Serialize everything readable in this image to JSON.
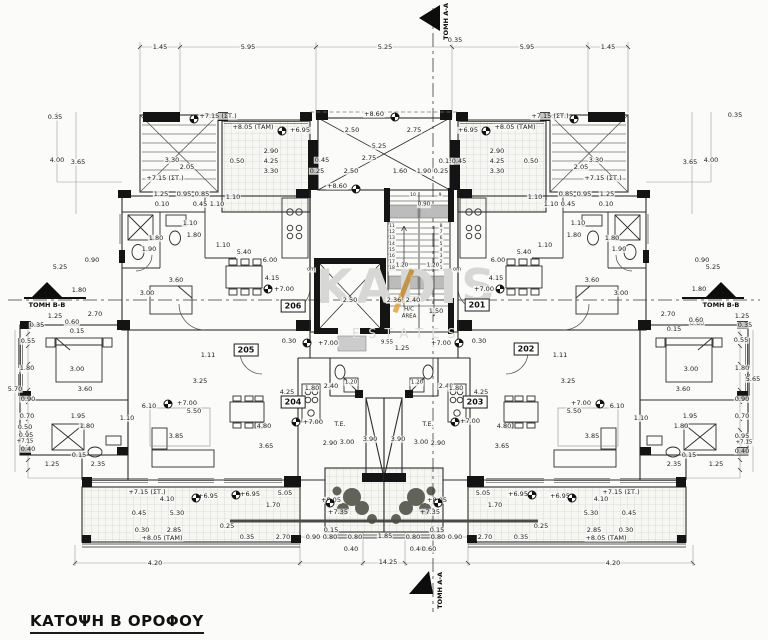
{
  "title": {
    "text": "ΚΑΤΟΨΗ Β ΟΡΟΦΟΥ"
  },
  "watermark": {
    "line1": "KADIS",
    "line2": "ESTATES",
    "accent_color": "#e2a23d"
  },
  "sections": {
    "labels": [
      "ΤΟΜΗ Α-Α",
      "ΤΟΜΗ Α-Α",
      "ΤΟΜΗ Β-Β",
      "ΤΟΜΗ Β-Β"
    ]
  },
  "apartments": [
    {
      "num": "206",
      "x": 293,
      "y": 306
    },
    {
      "num": "201",
      "x": 477,
      "y": 305
    },
    {
      "num": "205",
      "x": 246,
      "y": 350
    },
    {
      "num": "202",
      "x": 526,
      "y": 349
    },
    {
      "num": "204",
      "x": 293,
      "y": 402
    },
    {
      "num": "203",
      "x": 475,
      "y": 402
    }
  ],
  "level_markers": [
    {
      "x": 194,
      "y": 119
    },
    {
      "x": 574,
      "y": 119
    },
    {
      "x": 395,
      "y": 117
    },
    {
      "x": 356,
      "y": 189
    },
    {
      "x": 282,
      "y": 131
    },
    {
      "x": 486,
      "y": 131
    },
    {
      "x": 268,
      "y": 289
    },
    {
      "x": 500,
      "y": 289
    },
    {
      "x": 307,
      "y": 343
    },
    {
      "x": 459,
      "y": 343
    },
    {
      "x": 296,
      "y": 422
    },
    {
      "x": 455,
      "y": 422
    },
    {
      "x": 168,
      "y": 404
    },
    {
      "x": 600,
      "y": 404
    },
    {
      "x": 196,
      "y": 498
    },
    {
      "x": 572,
      "y": 498
    },
    {
      "x": 236,
      "y": 495
    },
    {
      "x": 532,
      "y": 495
    },
    {
      "x": 330,
      "y": 503
    },
    {
      "x": 438,
      "y": 503
    }
  ],
  "annotations": [
    {
      "t": "1.45",
      "x": 160,
      "y": 47
    },
    {
      "t": "5.95",
      "x": 248,
      "y": 47
    },
    {
      "t": "5.25",
      "x": 385,
      "y": 47
    },
    {
      "t": "5.95",
      "x": 527,
      "y": 47
    },
    {
      "t": "1.45",
      "x": 608,
      "y": 47
    },
    {
      "t": "0.35",
      "x": 455,
      "y": 40
    },
    {
      "t": "0.35",
      "x": 55,
      "y": 117
    },
    {
      "t": "0.35",
      "x": 735,
      "y": 115
    },
    {
      "t": "4.00",
      "x": 57,
      "y": 160
    },
    {
      "t": "3.65",
      "x": 78,
      "y": 162
    },
    {
      "t": "4.00",
      "x": 711,
      "y": 160
    },
    {
      "t": "3.65",
      "x": 690,
      "y": 162
    },
    {
      "t": "+7.15 (ΣΤ.)",
      "x": 218,
      "y": 116
    },
    {
      "t": "+7.15 (ΣΤ.)",
      "x": 550,
      "y": 116
    },
    {
      "t": "+8.05 (ΤΑΜ)",
      "x": 253,
      "y": 127
    },
    {
      "t": "+8.05 (ΤΑΜ)",
      "x": 515,
      "y": 127
    },
    {
      "t": "+6.95",
      "x": 300,
      "y": 130
    },
    {
      "t": "+6.95",
      "x": 468,
      "y": 130
    },
    {
      "t": "+8.60",
      "x": 374,
      "y": 114
    },
    {
      "t": "+8.60",
      "x": 337,
      "y": 186
    },
    {
      "t": "3.30",
      "x": 172,
      "y": 160
    },
    {
      "t": "2.05",
      "x": 187,
      "y": 167
    },
    {
      "t": "3.30",
      "x": 596,
      "y": 160
    },
    {
      "t": "2.05",
      "x": 581,
      "y": 167
    },
    {
      "t": "0.50",
      "x": 237,
      "y": 161
    },
    {
      "t": "0.50",
      "x": 531,
      "y": 161
    },
    {
      "t": "2.90",
      "x": 271,
      "y": 151
    },
    {
      "t": "4.25",
      "x": 271,
      "y": 161
    },
    {
      "t": "3.30",
      "x": 271,
      "y": 171
    },
    {
      "t": "2.90",
      "x": 497,
      "y": 151
    },
    {
      "t": "4.25",
      "x": 497,
      "y": 161
    },
    {
      "t": "3.30",
      "x": 497,
      "y": 171
    },
    {
      "t": "+7.15 (ΣΤ.)",
      "x": 165,
      "y": 178
    },
    {
      "t": "+7.15 (ΣΤ.)",
      "x": 603,
      "y": 178
    },
    {
      "t": "2.50",
      "x": 352,
      "y": 130
    },
    {
      "t": "2.75",
      "x": 414,
      "y": 130
    },
    {
      "t": "5.25",
      "x": 379,
      "y": 146
    },
    {
      "t": "2.75",
      "x": 369,
      "y": 158
    },
    {
      "t": "2.50",
      "x": 351,
      "y": 171
    },
    {
      "t": "1.60",
      "x": 400,
      "y": 171
    },
    {
      "t": "1.90",
      "x": 424,
      "y": 171
    },
    {
      "t": "0.45",
      "x": 322,
      "y": 160
    },
    {
      "t": "0.25",
      "x": 317,
      "y": 171
    },
    {
      "t": "0.15",
      "x": 446,
      "y": 161
    },
    {
      "t": "0.45",
      "x": 459,
      "y": 161
    },
    {
      "t": "0.25",
      "x": 441,
      "y": 171
    },
    {
      "t": "1.25",
      "x": 161,
      "y": 194
    },
    {
      "t": "0.95",
      "x": 184,
      "y": 194
    },
    {
      "t": "0.85",
      "x": 202,
      "y": 194
    },
    {
      "t": "0.85",
      "x": 566,
      "y": 194
    },
    {
      "t": "0.95",
      "x": 584,
      "y": 194
    },
    {
      "t": "1.25",
      "x": 607,
      "y": 194
    },
    {
      "t": "0.10",
      "x": 162,
      "y": 204
    },
    {
      "t": "0.45",
      "x": 200,
      "y": 204
    },
    {
      "t": "1.10",
      "x": 217,
      "y": 204
    },
    {
      "t": "1.10",
      "x": 551,
      "y": 204
    },
    {
      "t": "0.45",
      "x": 568,
      "y": 204
    },
    {
      "t": "0.10",
      "x": 606,
      "y": 204
    },
    {
      "t": "1.10",
      "x": 233,
      "y": 197
    },
    {
      "t": "1.10",
      "x": 535,
      "y": 197
    },
    {
      "t": "om",
      "x": 311,
      "y": 270,
      "s": 5
    },
    {
      "t": "om",
      "x": 457,
      "y": 270,
      "s": 5
    },
    {
      "t": "10",
      "x": 413,
      "y": 196,
      "s": 4.5
    },
    {
      "t": "9",
      "x": 440,
      "y": 196,
      "s": 4.5
    },
    {
      "t": "0.90",
      "x": 424,
      "y": 205,
      "s": 5.5
    },
    {
      "t": "11",
      "x": 392,
      "y": 227,
      "s": 4.5
    },
    {
      "t": "12",
      "x": 392,
      "y": 233,
      "s": 4.5
    },
    {
      "t": "13",
      "x": 392,
      "y": 239,
      "s": 4.5
    },
    {
      "t": "14",
      "x": 392,
      "y": 245,
      "s": 4.5
    },
    {
      "t": "15",
      "x": 392,
      "y": 251,
      "s": 4.5
    },
    {
      "t": "16",
      "x": 392,
      "y": 257,
      "s": 4.5
    },
    {
      "t": "17",
      "x": 392,
      "y": 263,
      "s": 4.5
    },
    {
      "t": "18",
      "x": 392,
      "y": 269,
      "s": 4.5
    },
    {
      "t": "8",
      "x": 441,
      "y": 227,
      "s": 4.5
    },
    {
      "t": "7",
      "x": 441,
      "y": 233,
      "s": 4.5
    },
    {
      "t": "6",
      "x": 441,
      "y": 239,
      "s": 4.5
    },
    {
      "t": "5",
      "x": 441,
      "y": 245,
      "s": 4.5
    },
    {
      "t": "4",
      "x": 441,
      "y": 251,
      "s": 4.5
    },
    {
      "t": "3",
      "x": 441,
      "y": 257,
      "s": 4.5
    },
    {
      "t": "2",
      "x": 441,
      "y": 263,
      "s": 4.5
    },
    {
      "t": "1",
      "x": 441,
      "y": 269,
      "s": 4.5
    },
    {
      "t": "1.20",
      "x": 402,
      "y": 266,
      "s": 5.5
    },
    {
      "t": "1.20",
      "x": 433,
      "y": 266,
      "s": 5.5
    },
    {
      "t": "1.10",
      "x": 190,
      "y": 223
    },
    {
      "t": "1.80",
      "x": 156,
      "y": 238
    },
    {
      "t": "1.80",
      "x": 194,
      "y": 235
    },
    {
      "t": "1.90",
      "x": 149,
      "y": 249
    },
    {
      "t": "1.10",
      "x": 223,
      "y": 245
    },
    {
      "t": "5.40",
      "x": 244,
      "y": 252
    },
    {
      "t": "6.00",
      "x": 270,
      "y": 260
    },
    {
      "t": "4.15",
      "x": 272,
      "y": 278
    },
    {
      "t": "3.60",
      "x": 176,
      "y": 280
    },
    {
      "t": "3.00",
      "x": 147,
      "y": 293
    },
    {
      "t": "1.10",
      "x": 578,
      "y": 223
    },
    {
      "t": "1.80",
      "x": 612,
      "y": 238
    },
    {
      "t": "1.80",
      "x": 574,
      "y": 235
    },
    {
      "t": "1.90",
      "x": 619,
      "y": 249
    },
    {
      "t": "1.10",
      "x": 545,
      "y": 245
    },
    {
      "t": "5.40",
      "x": 524,
      "y": 252
    },
    {
      "t": "6.00",
      "x": 498,
      "y": 260
    },
    {
      "t": "4.15",
      "x": 496,
      "y": 278
    },
    {
      "t": "3.60",
      "x": 592,
      "y": 280
    },
    {
      "t": "3.00",
      "x": 621,
      "y": 293
    },
    {
      "t": "+7.00",
      "x": 284,
      "y": 289
    },
    {
      "t": "+7.00",
      "x": 484,
      "y": 289
    },
    {
      "t": "2.50",
      "x": 350,
      "y": 300
    },
    {
      "t": "2.36",
      "x": 394,
      "y": 300
    },
    {
      "t": "2.40",
      "x": 413,
      "y": 300
    },
    {
      "t": "1.50",
      "x": 436,
      "y": 311
    },
    {
      "t": "H/C",
      "x": 409,
      "y": 310,
      "s": 5.5
    },
    {
      "t": "AREA",
      "x": 409,
      "y": 317,
      "s": 5.5
    },
    {
      "t": "0.30",
      "x": 289,
      "y": 341
    },
    {
      "t": "0.30",
      "x": 479,
      "y": 341
    },
    {
      "t": "+7.00",
      "x": 328,
      "y": 343
    },
    {
      "t": "+7.00",
      "x": 441,
      "y": 343
    },
    {
      "t": "9.55",
      "x": 387,
      "y": 343,
      "s": 5.5
    },
    {
      "t": "1.25",
      "x": 402,
      "y": 348
    },
    {
      "t": "1.11",
      "x": 208,
      "y": 355
    },
    {
      "t": "1.11",
      "x": 560,
      "y": 355
    },
    {
      "t": "5.25",
      "x": 60,
      "y": 267
    },
    {
      "t": "0.90",
      "x": 92,
      "y": 260
    },
    {
      "t": "1.80",
      "x": 79,
      "y": 290
    },
    {
      "t": "1.25",
      "x": 55,
      "y": 316
    },
    {
      "t": "0.60",
      "x": 72,
      "y": 322
    },
    {
      "t": "0.15",
      "x": 77,
      "y": 331
    },
    {
      "t": "0.35",
      "x": 37,
      "y": 325
    },
    {
      "t": "0.90",
      "x": 702,
      "y": 260
    },
    {
      "t": "5.25",
      "x": 713,
      "y": 267
    },
    {
      "t": "1.80",
      "x": 699,
      "y": 289
    },
    {
      "t": "1.25",
      "x": 742,
      "y": 316
    },
    {
      "t": "0.60",
      "x": 697,
      "y": 323
    },
    {
      "t": "0.15",
      "x": 674,
      "y": 329
    },
    {
      "t": "0.35",
      "x": 745,
      "y": 325
    },
    {
      "t": "2.70",
      "x": 95,
      "y": 314
    },
    {
      "t": "2.70",
      "x": 668,
      "y": 314
    },
    {
      "t": "0.60",
      "x": 696,
      "y": 320
    },
    {
      "t": "0.55",
      "x": 28,
      "y": 341
    },
    {
      "t": "1.80",
      "x": 27,
      "y": 368
    },
    {
      "t": "5.70",
      "x": 15,
      "y": 389
    },
    {
      "t": "0.90",
      "x": 28,
      "y": 399
    },
    {
      "t": "0.70",
      "x": 27,
      "y": 416
    },
    {
      "t": "0.50",
      "x": 25,
      "y": 427
    },
    {
      "t": "0.95",
      "x": 26,
      "y": 435
    },
    {
      "t": "+7.15",
      "x": 25,
      "y": 442,
      "s": 5.5
    },
    {
      "t": "0.40",
      "x": 28,
      "y": 449
    },
    {
      "t": "0.55",
      "x": 741,
      "y": 340
    },
    {
      "t": "1.80",
      "x": 742,
      "y": 368
    },
    {
      "t": "5.65",
      "x": 753,
      "y": 379
    },
    {
      "t": "0.90",
      "x": 742,
      "y": 399
    },
    {
      "t": "0.70",
      "x": 742,
      "y": 416
    },
    {
      "t": "0.95",
      "x": 742,
      "y": 436
    },
    {
      "t": "+7.15",
      "x": 744,
      "y": 443,
      "s": 5.5
    },
    {
      "t": "0.40",
      "x": 742,
      "y": 451
    },
    {
      "t": "3.00",
      "x": 77,
      "y": 369
    },
    {
      "t": "3.60",
      "x": 85,
      "y": 389
    },
    {
      "t": "1.95",
      "x": 78,
      "y": 416
    },
    {
      "t": "1.80",
      "x": 87,
      "y": 426
    },
    {
      "t": "1.10",
      "x": 127,
      "y": 418
    },
    {
      "t": "3.00",
      "x": 691,
      "y": 369
    },
    {
      "t": "3.60",
      "x": 683,
      "y": 389
    },
    {
      "t": "1.95",
      "x": 690,
      "y": 416
    },
    {
      "t": "1.80",
      "x": 681,
      "y": 426
    },
    {
      "t": "1.10",
      "x": 641,
      "y": 418
    },
    {
      "t": "2.35",
      "x": 98,
      "y": 464
    },
    {
      "t": "1.25",
      "x": 52,
      "y": 464
    },
    {
      "t": "0.15",
      "x": 79,
      "y": 455
    },
    {
      "t": "2.35",
      "x": 674,
      "y": 464
    },
    {
      "t": "1.25",
      "x": 716,
      "y": 464
    },
    {
      "t": "0.15",
      "x": 689,
      "y": 455
    },
    {
      "t": "3.25",
      "x": 200,
      "y": 381
    },
    {
      "t": "3.25",
      "x": 568,
      "y": 381
    },
    {
      "t": "6.10",
      "x": 149,
      "y": 406
    },
    {
      "t": "6.10",
      "x": 617,
      "y": 406
    },
    {
      "t": "+7.00",
      "x": 187,
      "y": 403
    },
    {
      "t": "+7.00",
      "x": 581,
      "y": 403
    },
    {
      "t": "5.50",
      "x": 194,
      "y": 411
    },
    {
      "t": "5.50",
      "x": 574,
      "y": 411
    },
    {
      "t": "3.85",
      "x": 176,
      "y": 436
    },
    {
      "t": "3.85",
      "x": 592,
      "y": 436
    },
    {
      "t": "4.80",
      "x": 264,
      "y": 426
    },
    {
      "t": "4.80",
      "x": 504,
      "y": 426
    },
    {
      "t": "3.65",
      "x": 266,
      "y": 446
    },
    {
      "t": "3.65",
      "x": 502,
      "y": 446
    },
    {
      "t": "4.25",
      "x": 287,
      "y": 392
    },
    {
      "t": "4.25",
      "x": 481,
      "y": 392
    },
    {
      "t": "2.40",
      "x": 331,
      "y": 386
    },
    {
      "t": "2.40",
      "x": 446,
      "y": 386
    },
    {
      "t": "1.80",
      "x": 312,
      "y": 388
    },
    {
      "t": "1.80",
      "x": 456,
      "y": 388
    },
    {
      "t": "1.20",
      "x": 351,
      "y": 383,
      "s": 5.5
    },
    {
      "t": "1.20",
      "x": 417,
      "y": 383,
      "s": 5.5
    },
    {
      "t": "+7.00",
      "x": 313,
      "y": 422
    },
    {
      "t": "+7.00",
      "x": 470,
      "y": 421
    },
    {
      "t": "T.E.",
      "x": 340,
      "y": 424
    },
    {
      "t": "T.E.",
      "x": 428,
      "y": 424
    },
    {
      "t": "2.90",
      "x": 330,
      "y": 443
    },
    {
      "t": "3.00",
      "x": 347,
      "y": 442
    },
    {
      "t": "3.90",
      "x": 370,
      "y": 439
    },
    {
      "t": "3.90",
      "x": 398,
      "y": 439
    },
    {
      "t": "3.00",
      "x": 421,
      "y": 442
    },
    {
      "t": "2.90",
      "x": 438,
      "y": 443
    },
    {
      "t": "+7.15 (ΣΤ.)",
      "x": 147,
      "y": 492
    },
    {
      "t": "+7.15 (ΣΤ.)",
      "x": 621,
      "y": 492
    },
    {
      "t": "4.10",
      "x": 167,
      "y": 499
    },
    {
      "t": "4.10",
      "x": 601,
      "y": 499
    },
    {
      "t": "+6.95",
      "x": 208,
      "y": 496
    },
    {
      "t": "+6.95",
      "x": 560,
      "y": 496
    },
    {
      "t": "+6.95",
      "x": 250,
      "y": 494
    },
    {
      "t": "+6.95",
      "x": 518,
      "y": 494
    },
    {
      "t": "5.05",
      "x": 285,
      "y": 493
    },
    {
      "t": "5.05",
      "x": 483,
      "y": 493
    },
    {
      "t": "1.70",
      "x": 273,
      "y": 505
    },
    {
      "t": "1.70",
      "x": 495,
      "y": 505
    },
    {
      "t": "+8.05",
      "x": 331,
      "y": 500
    },
    {
      "t": "+8.05",
      "x": 437,
      "y": 500
    },
    {
      "t": "+7.35",
      "x": 338,
      "y": 512
    },
    {
      "t": "+7.35",
      "x": 430,
      "y": 512
    },
    {
      "t": "0.45",
      "x": 139,
      "y": 513
    },
    {
      "t": "5.30",
      "x": 177,
      "y": 513
    },
    {
      "t": "5.30",
      "x": 591,
      "y": 513
    },
    {
      "t": "0.45",
      "x": 629,
      "y": 513
    },
    {
      "t": "0.30",
      "x": 142,
      "y": 530
    },
    {
      "t": "2.85",
      "x": 174,
      "y": 530
    },
    {
      "t": "2.85",
      "x": 594,
      "y": 530
    },
    {
      "t": "0.30",
      "x": 626,
      "y": 530
    },
    {
      "t": "+8.05 (ΤΑΜ)",
      "x": 162,
      "y": 538
    },
    {
      "t": "+8.05 (ΤΑΜ)",
      "x": 606,
      "y": 538
    },
    {
      "t": "0.25",
      "x": 227,
      "y": 526
    },
    {
      "t": "0.25",
      "x": 541,
      "y": 526
    },
    {
      "t": "0.35",
      "x": 247,
      "y": 537
    },
    {
      "t": "2.70",
      "x": 283,
      "y": 537
    },
    {
      "t": "0.90",
      "x": 313,
      "y": 537
    },
    {
      "t": "0.80",
      "x": 330,
      "y": 537
    },
    {
      "t": "0.15",
      "x": 331,
      "y": 530
    },
    {
      "t": "0.80",
      "x": 355,
      "y": 537
    },
    {
      "t": "0.40",
      "x": 351,
      "y": 549
    },
    {
      "t": "0.35",
      "x": 521,
      "y": 537
    },
    {
      "t": "2.70",
      "x": 485,
      "y": 537
    },
    {
      "t": "0.90",
      "x": 455,
      "y": 537
    },
    {
      "t": "0.80",
      "x": 438,
      "y": 537
    },
    {
      "t": "0.15",
      "x": 437,
      "y": 530
    },
    {
      "t": "0.80",
      "x": 413,
      "y": 537
    },
    {
      "t": "0.40",
      "x": 417,
      "y": 549
    },
    {
      "t": "0.60",
      "x": 429,
      "y": 549
    },
    {
      "t": "1.85",
      "x": 385,
      "y": 536
    },
    {
      "t": "4.20",
      "x": 155,
      "y": 563
    },
    {
      "t": "14.25",
      "x": 388,
      "y": 562
    },
    {
      "t": "4.20",
      "x": 613,
      "y": 563
    }
  ]
}
